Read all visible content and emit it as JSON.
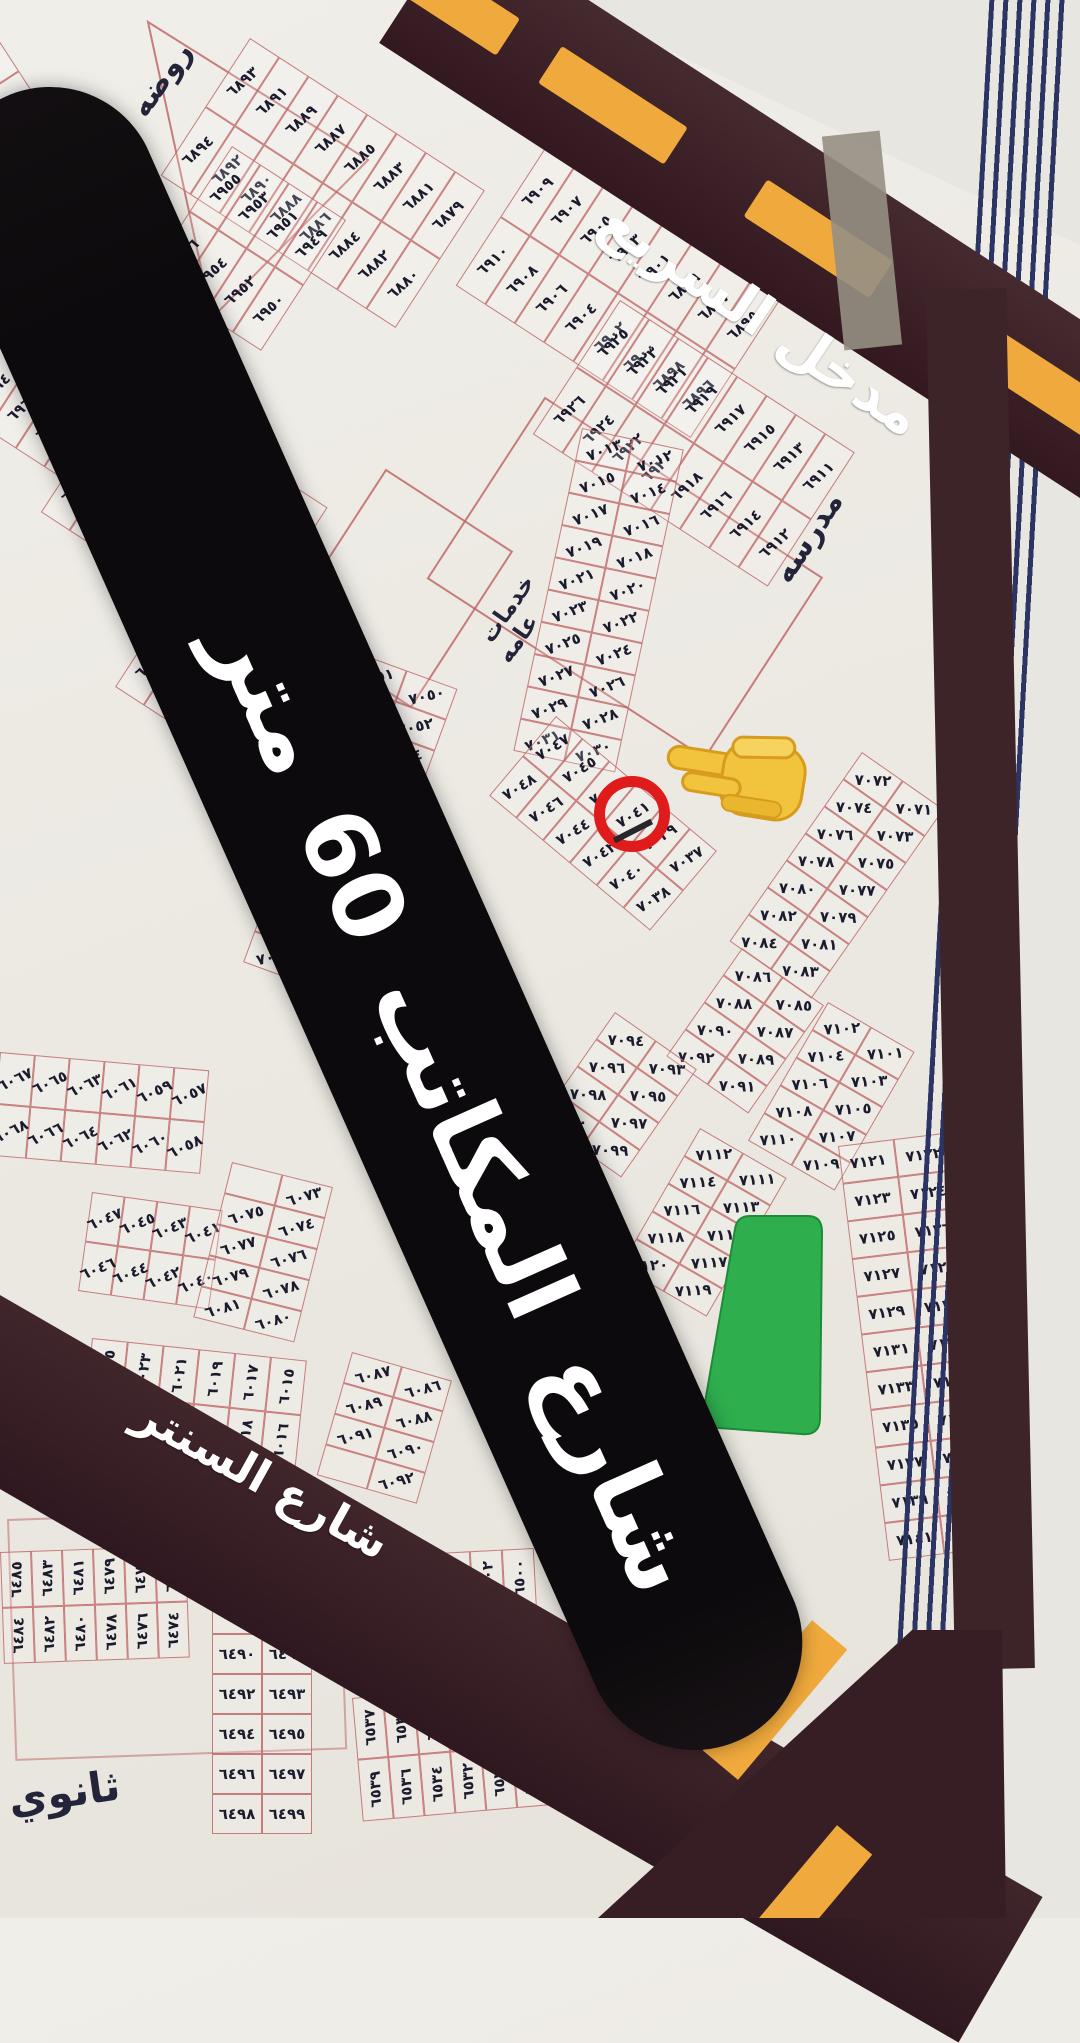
{
  "map": {
    "banner": {
      "street_label": "شارع المكاتب 60 متر"
    },
    "roads": {
      "highway_entrance": "مدخل السريع",
      "center_street": "شارع السنتر"
    },
    "landmarks": {
      "school": "مدرسه",
      "kindergarten": "روضه",
      "secondary_school": "ثانوي",
      "public_services_line1": "خدمات",
      "public_services_line2": "عامه"
    },
    "highlight": {
      "circled_plot": "٧٠٤٣",
      "pointer_emoji": "👈"
    },
    "colors": {
      "paper": "#edebe5",
      "road": "#3a2127",
      "dash_yellow": "#efa93c",
      "banner_black": "#0c0a0c",
      "plot_line_red": "#bb6060",
      "ink": "#1b1b2e",
      "park_green": "#2fae4e",
      "circle_red": "#e01b1b",
      "pinstripe_navy": "#2b3463",
      "wall": "#e8e6e1",
      "text_white": "#ffffff"
    },
    "blocks": [
      {
        "id": "a6935",
        "x": -18,
        "y": 14,
        "rot": 57,
        "cw": 34,
        "ch": 80,
        "tr": -80,
        "rows": [
          [
            "٦٩٣٥",
            "٦٩٣٧",
            "٦٩٣٩",
            "٦٩٤١",
            "٦٩٤٣"
          ],
          [
            "٦٩٤٠",
            "٦٩٤٢",
            "٦٩٤٤",
            "٦٩٤٦",
            "٦٩٤٨"
          ]
        ]
      },
      {
        "id": "a6879",
        "x": 250,
        "y": 38,
        "rot": 33,
        "cw": 35,
        "ch": 82,
        "tr": -75,
        "rows": [
          [
            "٦٨٧٩",
            "٦٨٨١",
            "٦٨٨٣",
            "٦٨٨٥",
            "٦٨٨٧",
            "٦٨٨٩",
            "٦٨٩١",
            "٦٨٩٣"
          ],
          [
            "٦٨٨٠",
            "٦٨٨٢",
            "٦٨٨٤",
            "٦٨٨٦",
            "٦٨٨٨",
            "٦٨٩٠",
            "٦٨٩٢",
            "٦٨٩٤"
          ]
        ]
      },
      {
        "id": "a6895",
        "x": 545,
        "y": 148,
        "rot": 33,
        "cw": 35,
        "ch": 82,
        "tr": -75,
        "rows": [
          [
            "٦٨٩٥",
            "٦٨٩٧",
            "٦٨٩٩",
            "٦٩٠١",
            "٦٩٠٣",
            "٦٩٠٥",
            "٦٩٠٧",
            "٦٩٠٩"
          ],
          [
            "٦٨٩٦",
            "٦٨٩٨",
            "٦٩٠٠",
            "٦٩٠٢",
            "٦٩٠٤",
            "٦٩٠٦",
            "٦٩٠٨",
            "٦٩١٠"
          ]
        ]
      },
      {
        "id": "a6911",
        "x": 620,
        "y": 300,
        "rot": 33,
        "cw": 35,
        "ch": 80,
        "tr": -75,
        "rows": [
          [
            "٦٩١١",
            "٦٩١٣",
            "٦٩١٥",
            "٦٩١٧",
            "٦٩١٩",
            "٦٩٢١",
            "٦٩٢٣",
            "٦٩٢٥"
          ],
          [
            "٦٩١٢",
            "٦٩١٤",
            "٦٩١٦",
            "٦٩١٨",
            "٦٩٢٠",
            "٦٩٢٢",
            "٦٩٢٤",
            "٦٩٢٦"
          ]
        ]
      },
      {
        "id": "a6949",
        "x": 232,
        "y": 146,
        "rot": 33,
        "cw": 34,
        "ch": 78,
        "tr": -75,
        "rows": [
          [
            "٦٩٤٩",
            "٦٩٥١",
            "٦٩٥٣",
            "٦٩٥٥"
          ],
          [
            "٦٩٥٠",
            "٦٩٥٢",
            "٦٩٥٤",
            "٦٩٥٦"
          ]
        ]
      },
      {
        "id": "a6957",
        "x": 15,
        "y": 262,
        "rot": 33,
        "cw": 34,
        "ch": 78,
        "tr": -75,
        "rows": [
          [
            "٦٩٥٧",
            "٦٩٥٩",
            "٦٩٦١",
            "٦٩٦٣",
            "٦٩٦٥"
          ],
          [
            "٦٩٥٨",
            "٦٩٦٠",
            "٦٩٦٢",
            "٦٩٦٤",
            "٦٩٦٦"
          ]
        ]
      },
      {
        "id": "a6975",
        "x": 128,
        "y": 378,
        "rot": 33,
        "cw": 34,
        "ch": 80,
        "tr": -75,
        "rows": [
          [
            "٦٩٧٥",
            "٦٩٧٧",
            "٦٩٧٩",
            "٦٩٨١",
            "٦٩٨٣",
            "٦٩٨٥",
            "٦٩٨٧"
          ],
          [
            "٦٩٧٦",
            "٦٩٧٨",
            "٦٩٨٠",
            "٦٩٨٢",
            "٦٩٨٤",
            "٦٩٨٦",
            "٦٩٨٨"
          ]
        ]
      },
      {
        "id": "a6989",
        "x": 200,
        "y": 556,
        "rot": 33,
        "cw": 34,
        "ch": 78,
        "tr": -75,
        "rows": [
          [
            "٦٩٨٩",
            "٦٩٩١",
            "٦٩٩٣",
            "٦٩٩٥",
            "٦٩٩٧"
          ],
          [
            "٦٩٩٠",
            "٦٩٩٢",
            "٦٩٩٤",
            "٦٩٩٦",
            "٦٩٩٨"
          ]
        ]
      },
      {
        "id": "a7012",
        "x": 582,
        "y": 428,
        "rot": 12,
        "cw": 52,
        "ch": 33,
        "tr": -33,
        "rows": [
          [
            "٧٠١٢",
            "٧٠١٣"
          ],
          [
            "٧٠١٤",
            "٧٠١٥"
          ],
          [
            "٧٠١٦",
            "٧٠١٧"
          ],
          [
            "٧٠١٨",
            "٧٠١٩"
          ],
          [
            "٧٠٢٠",
            "٧٠٢١"
          ],
          [
            "٧٠٢٢",
            "٧٠٢٣"
          ],
          [
            "٧٠٢٤",
            "٧٠٢٥"
          ],
          [
            "٧٠٢٦",
            "٧٠٢٧"
          ],
          [
            "٧٠٢٨",
            "٧٠٢٩"
          ],
          [
            "٧٠٣٠",
            "٧٠٣١"
          ]
        ]
      },
      {
        "id": "a7037",
        "x": 556,
        "y": 716,
        "rot": 40,
        "cw": 35,
        "ch": 52,
        "tr": -72,
        "rows": [
          [
            "٧٠٣٧",
            "٧٠٣٩",
            "٧٠٤١",
            "٧٠٤٣",
            "٧٠٤٥",
            "٧٠٤٧"
          ],
          [
            "٧٠٣٨",
            "٧٠٤٠",
            "٧٠٤٢",
            "٧٠٤٤",
            "٧٠٤٦",
            "٧٠٤٨"
          ]
        ]
      },
      {
        "id": "a7050",
        "x": 356,
        "y": 652,
        "rot": 20,
        "cw": 54,
        "ch": 33,
        "tr": -33,
        "rows": [
          [
            "٧٠٥٠",
            "٧٠٥١"
          ],
          [
            "٧٠٥٢",
            "٧٠٥٣"
          ],
          [
            "٧٠٥٤",
            "٧٠٥٥"
          ],
          [
            "٧٠٥٦",
            "٧٠٥٧"
          ],
          [
            "٧٠٥٨",
            "٧٠٥٩"
          ],
          [
            "٧٠٦٠",
            "٧٠٦١"
          ],
          [
            "٧٠٦٢",
            "٧٠٦٣"
          ],
          [
            "٧٠٦٤",
            "٧٠٦٥"
          ],
          [
            "٧٠٦٦",
            "٧٠٦٧"
          ],
          [
            "٧٠٦٨",
            "٧٠٦٩"
          ]
        ]
      },
      {
        "id": "a7071",
        "x": 862,
        "y": 752,
        "rot": 35,
        "cw": 50,
        "ch": 33,
        "tr": -33,
        "rows": [
          [
            "٧٠٧١",
            "٧٠٧٢"
          ],
          [
            "٧٠٧٣",
            "٧٠٧٤"
          ],
          [
            "٧٠٧٥",
            "٧٠٧٦"
          ],
          [
            "٧٠٧٧",
            "٧٠٧٨"
          ],
          [
            "٧٠٧٩",
            "٧٠٨٠"
          ],
          [
            "٧٠٨١",
            "٧٠٨٢"
          ],
          [
            "٧٠٨٣",
            "٧٠٨٤"
          ]
        ]
      },
      {
        "id": "a7085",
        "x": 742,
        "y": 948,
        "rot": 35,
        "cw": 50,
        "ch": 33,
        "tr": -33,
        "rows": [
          [
            "٧٠٨٥",
            "٧٠٨٦"
          ],
          [
            "٧٠٨٧",
            "٧٠٨٨"
          ],
          [
            "٧٠٨٩",
            "٧٠٩٠"
          ],
          [
            "٧٠٩١",
            "٧٠٩٢"
          ]
        ]
      },
      {
        "id": "a7093",
        "x": 615,
        "y": 1012,
        "rot": 35,
        "cw": 50,
        "ch": 33,
        "tr": -33,
        "rows": [
          [
            "٧٠٩٣",
            "٧٠٩٤"
          ],
          [
            "٧٠٩٥",
            "٧٠٩٦"
          ],
          [
            "٧٠٩٧",
            "٧٠٩٨"
          ],
          [
            "٧٠٩٩",
            "٧١٠٠"
          ]
        ]
      },
      {
        "id": "a7101",
        "x": 828,
        "y": 1002,
        "rot": 30,
        "cw": 50,
        "ch": 32,
        "tr": -33,
        "rows": [
          [
            "٧١٠١",
            "٧١٠٢"
          ],
          [
            "٧١٠٣",
            "٧١٠٤"
          ],
          [
            "٧١٠٥",
            "٧١٠٦"
          ],
          [
            "٧١٠٧",
            "٧١٠٨"
          ],
          [
            "٧١٠٩",
            "٧١١٠"
          ]
        ]
      },
      {
        "id": "a7111",
        "x": 700,
        "y": 1128,
        "rot": 30,
        "cw": 50,
        "ch": 32,
        "tr": -33,
        "rows": [
          [
            "٧١١١",
            "٧١١٢"
          ],
          [
            "٧١١٣",
            "٧١١٤"
          ],
          [
            "٧١١٥",
            "٧١١٦"
          ],
          [
            "٧١١٧",
            "٧١١٨"
          ],
          [
            "٧١١٩",
            "٧١٢٠"
          ]
        ]
      },
      {
        "id": "a7121",
        "x": 838,
        "y": 1146,
        "rot": -7,
        "cw": 56,
        "ch": 38,
        "tr": 0,
        "rows": [
          [
            "٧١٢٢",
            "٧١٢١"
          ],
          [
            "٧١٢٤",
            "٧١٢٣"
          ],
          [
            "٧١٢٦",
            "٧١٢٥"
          ],
          [
            "٧١٢٨",
            "٧١٢٧"
          ],
          [
            "٧١٣٠",
            "٧١٢٩"
          ],
          [
            "٧١٣٢",
            "٧١٣١"
          ],
          [
            "٧١٣٤",
            "٧١٣٣"
          ],
          [
            "٧١٣٦",
            "٧١٣٥"
          ],
          [
            "٧١٣٨",
            "٧١٣٧"
          ],
          [
            "٧١٤٠",
            "٧١٣٩"
          ],
          [
            "",
            "٧١٤١"
          ]
        ]
      },
      {
        "id": "a6057",
        "x": 0,
        "y": 1052,
        "rot": 5,
        "cw": 35,
        "ch": 52,
        "tr": -30,
        "rows": [
          [
            "٦٠٥٧",
            "٦٠٥٩",
            "٦٠٦١",
            "٦٠٦٣",
            "٦٠٦٥",
            "٦٠٦٧"
          ],
          [
            "٦٠٥٨",
            "٦٠٦٠",
            "٦٠٦٢",
            "٦٠٦٤",
            "٦٠٦٦",
            "٦٠٦٨"
          ]
        ]
      },
      {
        "id": "a6040",
        "x": 92,
        "y": 1192,
        "rot": 8,
        "cw": 33,
        "ch": 50,
        "tr": -30,
        "rows": [
          [
            "٦٠٤١",
            "٦٠٤٣",
            "٦٠٤٥",
            "٦٠٤٧"
          ],
          [
            "٦٠٤٠",
            "٦٠٤٢",
            "٦٠٤٤",
            "٦٠٤٦"
          ]
        ]
      },
      {
        "id": "a6073",
        "x": 232,
        "y": 1162,
        "rot": 14,
        "cw": 52,
        "ch": 32,
        "tr": -30,
        "rows": [
          [
            "٦٠٧٣",
            ""
          ],
          [
            "٦٠٧٤",
            "٦٠٧٥"
          ],
          [
            "٦٠٧٦",
            "٦٠٧٧"
          ],
          [
            "٦٠٧٨",
            "٦٠٧٩"
          ],
          [
            "٦٠٨٠",
            "٦٠٨١"
          ]
        ]
      },
      {
        "id": "a6015",
        "x": 92,
        "y": 1338,
        "rot": 6,
        "cw": 36,
        "ch": 55,
        "tr": -86,
        "rows": [
          [
            "٦٠١٥",
            "٦٠١٧",
            "٦٠١٩",
            "٦٠٢١",
            "٦٠٢٣",
            "٦٠٢٥"
          ],
          [
            "٦٠١٦",
            "٦٠١٨",
            "٦٠٢٠",
            "٦٠٢٢",
            "٦٠٢٤",
            "٦٠٢٦"
          ]
        ]
      },
      {
        "id": "a6086",
        "x": 352,
        "y": 1352,
        "rot": 16,
        "cw": 52,
        "ch": 32,
        "tr": -30,
        "rows": [
          [
            "٦٠٨٦",
            "٦٠٨٧"
          ],
          [
            "٦٠٨٨",
            "٦٠٨٩"
          ],
          [
            "٦٠٩٠",
            "٦٠٩١"
          ],
          [
            "٦٠٩٢",
            ""
          ]
        ]
      },
      {
        "id": "a6475",
        "x": 0,
        "y": 1552,
        "rot": -2,
        "cw": 31,
        "ch": 56,
        "tr": -87,
        "rows": [
          [
            "٦٤٧٥",
            "٦٤٧٧",
            "٦٤٧٩",
            "٦٤٨١",
            "٦٤٨٣",
            "٦٤٨٥"
          ],
          [
            "٦٤٧٤",
            "٦٤٧٦",
            "٦٤٧٨",
            "٦٤٨٠",
            "٦٤٨٢",
            "٦٤٨٤"
          ]
        ]
      },
      {
        "id": "a6486",
        "x": 212,
        "y": 1554,
        "rot": 0,
        "cw": 50,
        "ch": 40,
        "tr": 0,
        "rows": [
          [
            "٦٤٨٧",
            "٦٤٨٦"
          ],
          [
            "٦٤٨٩",
            "٦٤٨٨"
          ],
          [
            "٦٤٩١",
            "٦٤٩٠"
          ],
          [
            "٦٤٩٣",
            "٦٤٩٢"
          ],
          [
            "٦٤٩٥",
            "٦٤٩٤"
          ],
          [
            "٦٤٩٧",
            "٦٤٩٦"
          ],
          [
            "٦٤٩٩",
            "٦٤٩٨"
          ]
        ]
      },
      {
        "id": "a6500",
        "x": 342,
        "y": 1558,
        "rot": -3,
        "cw": 32,
        "ch": 58,
        "tr": -87,
        "rows": [
          [
            "٦٥٠٠",
            "٦٥٠٢",
            "٦٥٠٤",
            "٦٥٠٦",
            "٦٥٠٨",
            "٦٥١٠"
          ],
          [
            "٦٥٠١",
            "٦٥٠٣",
            "٦٥٠٥",
            "٦٥٠٧",
            "٦٥٠٩",
            "٦٥١١"
          ]
        ]
      },
      {
        "id": "a6517",
        "x": 352,
        "y": 1698,
        "rot": -5,
        "cw": 31,
        "ch": 62,
        "tr": -87,
        "rows": [
          [
            "٦٥١٧",
            "٦٥١٩",
            "٦٥٢١",
            "٦٥٢٣",
            "٦٥٢٥",
            "٦٥٢٧",
            "٦٥٢٩",
            "٦٥٣١",
            "٦٥٣٣",
            "٦٥٣٥",
            "٦٥٣٧"
          ],
          [
            "٦٥١٨",
            "٦٥٢٠",
            "٦٥٢٢",
            "٦٥٢٤",
            "٦٥٢٦",
            "٦٥٢٨",
            "٦٥٣٠",
            "٦٥٣٢",
            "٦٥٣٤",
            "٦٥٣٦",
            "٦٥٣٩"
          ]
        ]
      }
    ]
  }
}
